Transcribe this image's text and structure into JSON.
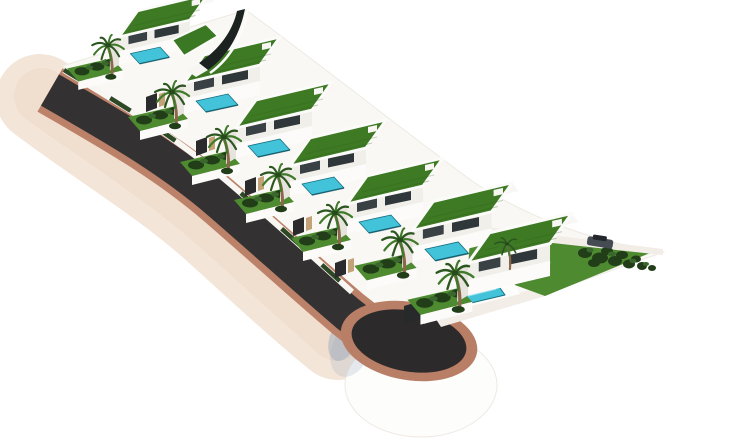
{
  "scene": {
    "width": 740,
    "height": 445,
    "subject": "aerial-3d-render-of-terraced-villa-development-with-road-and-cul-de-sac",
    "villa_count": 7
  },
  "colors": {
    "bg": "#ffffff",
    "cream": "#f3e6d9",
    "creamDeep": "#ecd7c6",
    "salmon": "#bb8169",
    "ringSalmon": "#b87e66",
    "asphalt": "#343132",
    "asphaltPad": "#2d2a2b",
    "white": "#fdfdfc",
    "baseEdge": "#efe9e2",
    "plateau": "#faf8f4",
    "plateauEdge": "#edeae4",
    "wallWhite": "#f8f6f3",
    "wallWhite2": "#fcfbfa",
    "wallShade": "#e7e3dd",
    "facade": "#f1efe9",
    "window": "#3a4144",
    "window2": "#30373a",
    "parapet": "#fbfbf9",
    "roof": "#3e7a24",
    "roofBright": "#3b7823",
    "roofLine": "#2c5a17",
    "lawn": "#4d8a30",
    "hedgeDark": "#213e19",
    "hedgeLight": "#3a672c",
    "pool": "#43c3d9",
    "poolEdge": "#15707f",
    "poolDark": "#0d4f5c",
    "poolSparkle": "#d6f4f8",
    "trunk": "#8a684a",
    "palmA": "#2c5620",
    "palmB": "#3f7a2b",
    "palmCore": "#27491c",
    "gate": "#2b2b2d",
    "pillar": "#c2a276",
    "pathWhite": "#f2ede7",
    "sail": "#1c2220",
    "shadowBlue": "#9fabc0",
    "carBody": "#454b53",
    "carTop": "#23272c",
    "boxDark": "#28292b",
    "boxTan": "#bfa074"
  },
  "shapes": [
    {
      "name": "background",
      "t": "rect",
      "x": 0,
      "y": 0,
      "w": 740,
      "h": 445,
      "f": "bg"
    },
    {
      "name": "embankment",
      "t": "path",
      "d": "M 40,98 C 104,146 162,180 216,228 C 260,268 300,305 338,336",
      "s": "cream",
      "w": 88,
      "cap": "round"
    },
    {
      "name": "embankment-shade",
      "t": "path",
      "d": "M 42,96 C 106,142 163,177 217,225 C 261,265 301,301 337,333",
      "s": "creamDeep",
      "w": 56,
      "cap": "round",
      "o": 0.55
    },
    {
      "name": "culdesac-base",
      "t": "ell",
      "cx": 421,
      "cy": 385,
      "rx": 76,
      "ry": 52,
      "f": "white",
      "s": "baseEdge",
      "w": 1
    },
    {
      "name": "culdesac-shadow",
      "t": "ell",
      "cx": 344,
      "cy": 338,
      "rx": 14,
      "ry": 24,
      "f": "shadowBlue",
      "o": 0.5,
      "transform": "rotate(22 344 338)"
    },
    {
      "name": "culdesac-shadow-soft",
      "t": "ell",
      "cx": 351,
      "cy": 349,
      "rx": 19,
      "ry": 29,
      "f": "shadowBlue",
      "o": 0.25,
      "transform": "rotate(22 351 349)"
    },
    {
      "name": "plateau",
      "t": "path",
      "d": "M 62,66 L 246,10 C 330,72 408,134 472,181 C 534,222 604,244 664,252 L 548,293 L 470,316 L 430,322 L 366,325 C 330,292 290,252 240,208 C 192,165 122,112 62,66 Z",
      "f": "plateau",
      "s": "plateauEdge",
      "w": 1
    },
    {
      "name": "road-sidewalk",
      "t": "path",
      "d": "M 50,90 C 112,126 168,157 220,202 C 264,240 308,280 348,314 L 366,328",
      "s": "salmon",
      "w": 50
    },
    {
      "name": "road-asphalt",
      "t": "path",
      "d": "M 50,90 C 112,126 168,157 220,202 C 264,240 308,280 348,314 L 366,328",
      "s": "asphalt",
      "w": 36
    },
    {
      "name": "culdesac-ring",
      "t": "ell",
      "cx": 409,
      "cy": 341,
      "rx": 69,
      "ry": 39,
      "f": "ringSalmon",
      "transform": "rotate(10 409 341)"
    },
    {
      "name": "culdesac-pad",
      "t": "ell",
      "cx": 409,
      "cy": 341,
      "rx": 58,
      "ry": 30.5,
      "f": "asphaltPad",
      "transform": "rotate(10 409 341)"
    },
    {
      "name": "path-to-villa",
      "t": "poly",
      "pts": [
        434,
        316,
        545,
        286,
        552,
        294,
        441,
        327
      ],
      "f": "pathWhite"
    },
    {
      "name": "triangle-lawn",
      "t": "path",
      "d": "M 470,240 C 500,233 530,232 552,238 L 655,251 L 545,296 L 468,268 Z",
      "f": "lawn"
    },
    {
      "name": "triangle-path",
      "t": "poly",
      "pts": [
        488,
        227,
        663,
        249,
        663,
        255,
        488,
        236
      ],
      "f": "pathWhite"
    },
    {
      "name": "bush",
      "t": "ell",
      "cx": 585,
      "cy": 253,
      "rx": 7,
      "ry": 5,
      "f": "hedgeDark"
    },
    {
      "name": "bush",
      "t": "ell",
      "cx": 600,
      "cy": 258,
      "rx": 8,
      "ry": 5.5,
      "f": "hedgeDark"
    },
    {
      "name": "bush",
      "t": "ell",
      "cx": 615,
      "cy": 261,
      "rx": 7,
      "ry": 5,
      "f": "hedgeDark"
    },
    {
      "name": "bush",
      "t": "ell",
      "cx": 629,
      "cy": 264,
      "rx": 6,
      "ry": 4.5,
      "f": "hedgeDark"
    },
    {
      "name": "bush",
      "t": "ell",
      "cx": 642,
      "cy": 266,
      "rx": 5,
      "ry": 4,
      "f": "hedgeDark"
    },
    {
      "name": "bush",
      "t": "ell",
      "cx": 652,
      "cy": 268,
      "rx": 4,
      "ry": 3,
      "f": "hedgeDark"
    },
    {
      "name": "bush",
      "t": "ell",
      "cx": 607,
      "cy": 251,
      "rx": 6,
      "ry": 4,
      "f": "hedgeDark"
    },
    {
      "name": "bush",
      "t": "ell",
      "cx": 622,
      "cy": 255,
      "rx": 6,
      "ry": 4,
      "f": "hedgeDark"
    },
    {
      "name": "bush",
      "t": "ell",
      "cx": 594,
      "cy": 263,
      "rx": 6,
      "ry": 4,
      "f": "hedgeDark"
    },
    {
      "name": "bush",
      "t": "ell",
      "cx": 636,
      "cy": 259,
      "rx": 5,
      "ry": 3.5,
      "f": "hedgeDark"
    },
    {
      "name": "bush-light",
      "t": "ell",
      "cx": 590,
      "cy": 250,
      "rx": 3.5,
      "ry": 2.5,
      "f": "hedgeLight"
    },
    {
      "name": "bush-light",
      "t": "ell",
      "cx": 612,
      "cy": 254,
      "rx": 4,
      "ry": 2.5,
      "f": "hedgeLight"
    },
    {
      "name": "bush-light",
      "t": "ell",
      "cx": 633,
      "cy": 261,
      "rx": 3.5,
      "ry": 2.2,
      "f": "hedgeLight"
    },
    {
      "name": "bush-light",
      "t": "ell",
      "cx": 646,
      "cy": 264,
      "rx": 3,
      "ry": 2,
      "f": "hedgeLight"
    },
    {
      "name": "car",
      "t": "rect",
      "x": -13,
      "y": -5,
      "w": 26,
      "h": 9,
      "rx": 2.5,
      "f": "carBody",
      "transform": "translate(600,243) rotate(9)"
    },
    {
      "name": "car-cabin",
      "t": "rect",
      "x": -8,
      "y": -7.5,
      "w": 14,
      "h": 5,
      "rx": 1.5,
      "f": "carTop",
      "transform": "translate(600,243) rotate(9)"
    },
    {
      "name": "roadside-wall",
      "t": "path",
      "d": "M 64,70 C 120,104 170,133 222,177 C 266,214 310,254 352,292",
      "s": "wallWhite",
      "w": 6
    },
    {
      "name": "roadside-hedge",
      "t": "path",
      "d": "M 64,70 C 120,104 170,133 222,177 C 266,214 310,254 352,292",
      "s": "hedgeDark",
      "w": 4.5,
      "dash": "24 30",
      "o": 0.95
    },
    {
      "name": "utility-box-dark",
      "t": "poly",
      "pts": [
        404,
        306,
        421,
        301,
        421,
        319,
        404,
        324
      ],
      "f": "boxDark"
    },
    {
      "name": "utility-box-tan",
      "t": "poly",
      "pts": [
        424,
        309,
        436,
        305,
        436,
        320,
        424,
        324
      ],
      "f": "boxTan"
    },
    {
      "name": "pool-deck",
      "t": "poly",
      "pts": [
        452,
        282,
        506,
        269,
        520,
        294,
        466,
        307
      ],
      "f": "white"
    },
    {
      "name": "villa7-pool",
      "t": "poly",
      "pts": [
        461,
        289,
        495,
        281,
        505,
        295,
        471,
        303
      ],
      "f": "pool",
      "s": "poolEdge",
      "w": 1
    },
    {
      "name": "villa7-pool-sparkle",
      "t": "line",
      "x1": 468,
      "y1": 296,
      "x2": 496,
      "y2": 289,
      "s": "poolSparkle",
      "w": 1.2,
      "o": 0.6
    }
  ],
  "post_shapes": [
    {
      "name": "entry-sail",
      "t": "path",
      "d": "M 245,9 C 240,34 228,56 208,70 L 199,63 C 220,49 233,30 237,11 Z",
      "f": "sail"
    },
    {
      "name": "entry-sail-edge",
      "t": "path",
      "d": "M 248,7 C 244,34 231,58 210,73",
      "s": "parapet",
      "w": 2.6
    },
    {
      "name": "entry-sail-base",
      "t": "poly",
      "pts": [
        208,
        70,
        199,
        63,
        186,
        70,
        196,
        77
      ],
      "f": "wallWhite"
    },
    {
      "name": "villa1-roof-wing",
      "t": "poly",
      "pts": [
        172,
        40,
        206,
        24,
        218,
        36,
        184,
        56
      ],
      "f": "roofBright",
      "s": "parapet",
      "w": 2
    }
  ],
  "villas": [
    {
      "x": 108,
      "y": 48,
      "scale": 0.93,
      "pool": true
    },
    {
      "x": 172,
      "y": 95,
      "scale": 1,
      "pool": true
    },
    {
      "x": 224,
      "y": 140,
      "scale": 1,
      "pool": true
    },
    {
      "x": 278,
      "y": 178,
      "scale": 1,
      "pool": true
    },
    {
      "x": 335,
      "y": 216,
      "scale": 1,
      "pool": true
    },
    {
      "x": 400,
      "y": 243,
      "scale": 1.04,
      "pool": true
    },
    {
      "x": 455,
      "y": 276,
      "scale": 1.08,
      "pool": false
    }
  ],
  "villa_template": [
    {
      "t": "poly",
      "pts": [
        32,
        -40,
        108,
        -58,
        114,
        -50,
        38,
        -32
      ],
      "f": "wallWhite",
      "o": 0.85,
      "name": "upper-terrace"
    },
    {
      "t": "poly",
      "pts": [
        -44,
        22,
        4,
        11,
        16,
        24,
        -32,
        36
      ],
      "f": "lawn",
      "name": "garden-lawn"
    },
    {
      "t": "poly",
      "pts": [
        -32,
        36,
        16,
        24,
        16,
        33,
        -32,
        45
      ],
      "f": "wallWhite2",
      "name": "garden-wall"
    },
    {
      "t": "ell",
      "cx": -28,
      "cy": 25,
      "rx": 8,
      "ry": 4.5,
      "f": "hedgeDark",
      "name": "hedge"
    },
    {
      "t": "ell",
      "cx": -12,
      "cy": 20,
      "rx": 8,
      "ry": 4.5,
      "f": "hedgeDark",
      "name": "hedge"
    },
    {
      "t": "ell",
      "cx": 3,
      "cy": 16,
      "rx": 7,
      "ry": 4,
      "f": "hedgeDark",
      "name": "hedge"
    },
    {
      "t": "ell",
      "cx": -20,
      "cy": 21,
      "rx": 4,
      "ry": 2.4,
      "f": "hedgeLight",
      "name": "hedge"
    },
    {
      "t": "ell",
      "cx": -3,
      "cy": 16.5,
      "rx": 4,
      "ry": 2.4,
      "f": "hedgeLight",
      "name": "hedge"
    },
    {
      "t": "poly",
      "pts": [
        12,
        -12,
        12,
        18,
        2,
        24,
        2,
        -6
      ],
      "f": "wallShade",
      "name": "side-wall"
    },
    {
      "t": "poly",
      "pts": [
        12,
        5,
        88,
        -13,
        88,
        0,
        12,
        18
      ],
      "f": "wallWhite2",
      "name": "lower-wall"
    },
    {
      "t": "poly",
      "pts": [
        12,
        -12,
        88,
        -30,
        88,
        -13,
        12,
        5
      ],
      "f": "facade",
      "name": "facade"
    },
    {
      "t": "poly",
      "pts": [
        22,
        -13,
        42,
        -17.5,
        42,
        -8.5,
        22,
        -4
      ],
      "f": "window",
      "name": "window"
    },
    {
      "t": "poly",
      "pts": [
        50,
        -19.5,
        76,
        -25,
        76,
        -16,
        50,
        -10.5
      ],
      "f": "window2",
      "name": "window"
    },
    {
      "t": "line",
      "x1": 12,
      "y1": 5,
      "x2": 88,
      "y2": -13,
      "s": "parapet",
      "w": 2.2,
      "name": "terrace-slab"
    },
    {
      "t": "poly",
      "pts": [
        24,
        6,
        56,
        -1,
        66,
        10,
        34,
        17
      ],
      "f": "pool",
      "s": "poolEdge",
      "w": 0.8,
      "pool": true,
      "name": "pool"
    },
    {
      "t": "line",
      "x1": 34,
      "y1": 17,
      "x2": 66,
      "y2": 10,
      "s": "poolDark",
      "w": 1.6,
      "o": 0.65,
      "pool": true,
      "name": "pool-edge"
    },
    {
      "t": "poly",
      "pts": [
        12,
        -12,
        88,
        -30,
        108,
        -58,
        32,
        -40
      ],
      "f": "roof",
      "s": "parapet",
      "w": 2.8,
      "name": "green-roof"
    },
    {
      "t": "line",
      "x1": 20,
      "y1": -17,
      "x2": 94,
      "y2": -35,
      "s": "roofLine",
      "w": 1.1,
      "o": 0.3,
      "name": "roof-grass-line"
    },
    {
      "t": "line",
      "x1": 27,
      "y1": -24,
      "x2": 99,
      "y2": -41,
      "s": "roofLine",
      "w": 1.1,
      "o": 0.25,
      "name": "roof-grass-line"
    },
    {
      "t": "poly",
      "pts": [
        90,
        -45,
        99,
        -47,
        99,
        -53,
        90,
        -51
      ],
      "f": "wallWhite",
      "name": "roof-box"
    },
    {
      "t": "path",
      "d": "M 4,32 Q 6,14 0,-1",
      "s": "trunk",
      "w": 3,
      "cap": "round",
      "name": "palm-trunk"
    },
    {
      "t": "ell",
      "cx": 3,
      "cy": 31,
      "rx": 6,
      "ry": 3.2,
      "f": "hedgeDark",
      "name": "base-shrub"
    },
    {
      "t": "fronds",
      "tips": [
        [
          -17,
          -3
        ],
        [
          -15,
          7
        ],
        [
          -7,
          12
        ],
        [
          3,
          13
        ],
        [
          12,
          9
        ],
        [
          17,
          1
        ],
        [
          13,
          -9
        ],
        [
          4,
          -14
        ],
        [
          -8,
          -11
        ]
      ],
      "name": "palm-fronds"
    },
    {
      "t": "ell",
      "cx": 0,
      "cy": -3,
      "rx": 3,
      "ry": 2.2,
      "f": "palmCore",
      "name": "palm-crown-core"
    }
  ],
  "gates": [
    [
      95,
      78
    ],
    [
      146,
      112
    ],
    [
      196,
      156
    ],
    [
      245,
      196
    ],
    [
      293,
      236
    ],
    [
      335,
      278
    ]
  ],
  "gate_template": [
    {
      "t": "poly",
      "pts": [
        0,
        0,
        11,
        -4,
        11,
        -19,
        0,
        -15
      ],
      "f": "gate",
      "name": "entry-gate"
    },
    {
      "t": "poly",
      "pts": [
        13,
        -5,
        19,
        -7,
        19,
        -20,
        13,
        -18
      ],
      "f": "pillar",
      "name": "gate-pillar"
    }
  ],
  "extra_palms": [
    [
      507,
      246,
      0.72
    ]
  ]
}
